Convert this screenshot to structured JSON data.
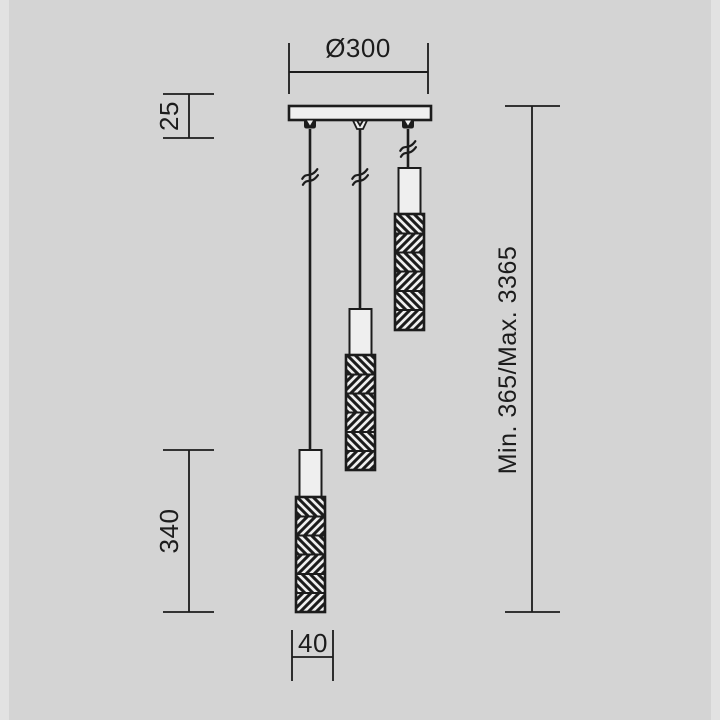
{
  "colors": {
    "background": "#d4d4d4",
    "ink": "#1c1c1c",
    "paper": "#efefef"
  },
  "labels": {
    "canopy_diameter": "Ø300",
    "canopy_height": "25",
    "shade_length": "340",
    "shade_diameter": "40",
    "suspension_height": "Min. 365/Max. 3365"
  }
}
